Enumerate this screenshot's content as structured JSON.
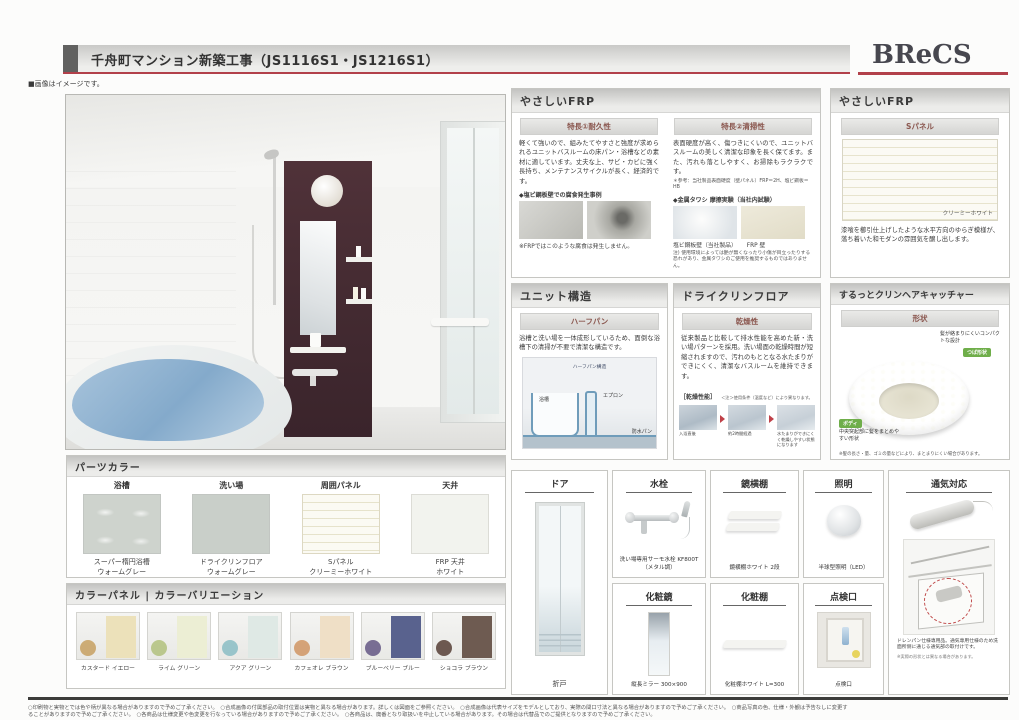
{
  "header": {
    "title": "千舟町マンション新築工事（JS1116S1・JS1216S1）",
    "logo_text": "BReCS",
    "image_note": "■画像はイメージです。",
    "accent_red": "#b2404a"
  },
  "panels": {
    "frp": {
      "title": "やさしいFRP",
      "durability": {
        "heading": "特長①耐久性",
        "body": "軽くて強いので、組みたてやすさと強度が求められるユニットバスルームの床パン・浴槽などの素材に適しています。丈夫な上、サビ・カビに強く長持ち、メンテナンスサイクルが長く、経済的です。",
        "photo_heading": "◆塩ビ鋼板壁での腐食発生事例",
        "photo_caption": "※FRPではこのような腐食は発生しません。"
      },
      "cleanability": {
        "heading": "特長②清掃性",
        "body": "表面硬度が高く、傷つきにくいので、ユニットバスルームの美しく清潔な印象を長く保てます。また、汚れも落としやすく、お掃除もラクラクです。",
        "reference": "＊参考：当社製品表面硬度（壁パネル）FRP＝2H、塩ビ鋼板＝HB",
        "photo_heading": "◆金属タワシ 摩擦実験（当社内試験）",
        "caption_left": "塩ビ鋼板壁（当社製品）",
        "caption_right": "FRP 壁",
        "note": "注) 使用環境によっては艶が無くなったり小傷が目立ったりする恐れがあり、金属タワシのご使用を推奨するものではありません。"
      }
    },
    "frp_s": {
      "title": "やさしいFRP",
      "subtitle": "Sパネル",
      "swatch_label": "クリーミーホワイト",
      "swatch_color": "#f7f5e6",
      "body": "漆喰を櫛引仕上げしたような水平方向のゆらぎ模様が、落ち着いた和モダンの雰囲気を醸し出します。"
    },
    "unit": {
      "title": "ユニット構造",
      "subtitle": "ハーフパン",
      "body": "浴槽と洗い場を一体成形しているため、面倒な浴槽下の清掃が不要で清潔な構造です。",
      "diagram_labels": [
        "ハーフパン構造",
        "浴槽",
        "エプロン",
        "防水パン"
      ]
    },
    "dry": {
      "title": "ドライクリンフロア",
      "subtitle": "乾燥性",
      "body": "従来製品と比較して排水性能を高めた新・洗い場パターンを採用。洗い場面の乾燥時間が短縮されますので、汚れのもととなる水たまりができにくく、清潔なバスルームを維持できます。",
      "perf_label": "［乾燥性能］",
      "perf_note": "＜注＞使用条件（温度など）により異なります。",
      "steps": [
        "入浴直後",
        "約2時間経過",
        "水たまりができにくく乾燥しやすい状態になります"
      ]
    },
    "hair": {
      "title": "するっとクリンヘアキャッチャー",
      "subtitle": "形状",
      "label_top": "髪が絡まりにくいコンパクトな設計",
      "badge_top": "つば形状",
      "badge_bottom": "ボディ",
      "label_bottom": "中央突起部に髪をまとめやすい形状",
      "badge_color": "#6fae4a",
      "footnote": "※髪の長さ・量、ゴミの量などにより、まとまりにくい場合があります。"
    }
  },
  "parts_color": {
    "title": "パーツカラー",
    "items": [
      {
        "label": "浴槽",
        "caption1": "スーパー楕円浴槽",
        "caption2": "ウォームグレー",
        "color": "#ced3cd"
      },
      {
        "label": "洗い場",
        "caption1": "ドライクリンフロア",
        "caption2": "ウォームグレー",
        "color": "#c9cfc9"
      },
      {
        "label": "周囲パネル",
        "caption1": "Sパネル",
        "caption2": "クリーミーホワイト",
        "color": "#f6f4e4"
      },
      {
        "label": "天井",
        "caption1": "FRP 天井",
        "caption2": "ホワイト",
        "color": "#f2f3ee"
      }
    ]
  },
  "color_panel": {
    "title": "カラーパネル | カラーバリエーション",
    "items": [
      {
        "label": "カスタード イエロー",
        "panel": "#ece1ba",
        "photo": "#c9a468"
      },
      {
        "label": "ライム グリーン",
        "panel": "#eceed4",
        "photo": "#b5c383"
      },
      {
        "label": "アクア グリーン",
        "panel": "#dfe9e5",
        "photo": "#8fc0c6"
      },
      {
        "label": "カフェオレ ブラウン",
        "panel": "#efdfc6",
        "photo": "#d29a6a"
      },
      {
        "label": "ブルーベリー ブルー",
        "panel": "#59628e",
        "photo": "#6b5f8a"
      },
      {
        "label": "ショコラ ブラウン",
        "panel": "#6e5b51",
        "photo": "#5e483f"
      }
    ]
  },
  "products": {
    "door": {
      "title": "ドア",
      "caption": "折戸"
    },
    "faucet": {
      "title": "水栓",
      "caption": "洗い場専用サーモ水栓 KF800T（メタル調）"
    },
    "mirror_shelf": {
      "title": "鏡横棚",
      "caption": "鏡横棚ホワイト 2段"
    },
    "light": {
      "title": "照明",
      "caption": "半球型照明（LED）"
    },
    "vanity_mirror": {
      "title": "化粧鏡",
      "caption": "縦長ミラー 300×900"
    },
    "vanity_shelf": {
      "title": "化粧棚",
      "caption": "化粧棚ホワイト L=300"
    },
    "hatch": {
      "title": "点検口",
      "caption": "点検口"
    },
    "vent": {
      "title": "通気対応",
      "caption": "ドレンパン仕様専用品。通気専用仕様のため洗面所側に通じる通気部の取付けです。",
      "note": "※実際の形状とは異なる場合があります。"
    }
  },
  "footer": {
    "line1": "○印刷物と実物とでは色や柄が異なる場合がありますので予めご了承ください。　○合成画像の付属部品の取付位置は実物と異なる場合があります。詳しくは図面をご参照ください。　○合成画像は代表サイズをモデルとしており、実際の間口寸法と異なる場合がありますので予めご了承ください。　○商品写真の色、仕様・外観は予告なしに変更す",
    "line2": "ることがありますので予めご了承ください。　○各商品は仕様変更や色変更を行なっている場合がありますので予めご了承ください。　○各商品は、廃番となり取扱いを中止している場合があります。その場合は代替品でのご提供となりますので予めご了承ください。"
  }
}
